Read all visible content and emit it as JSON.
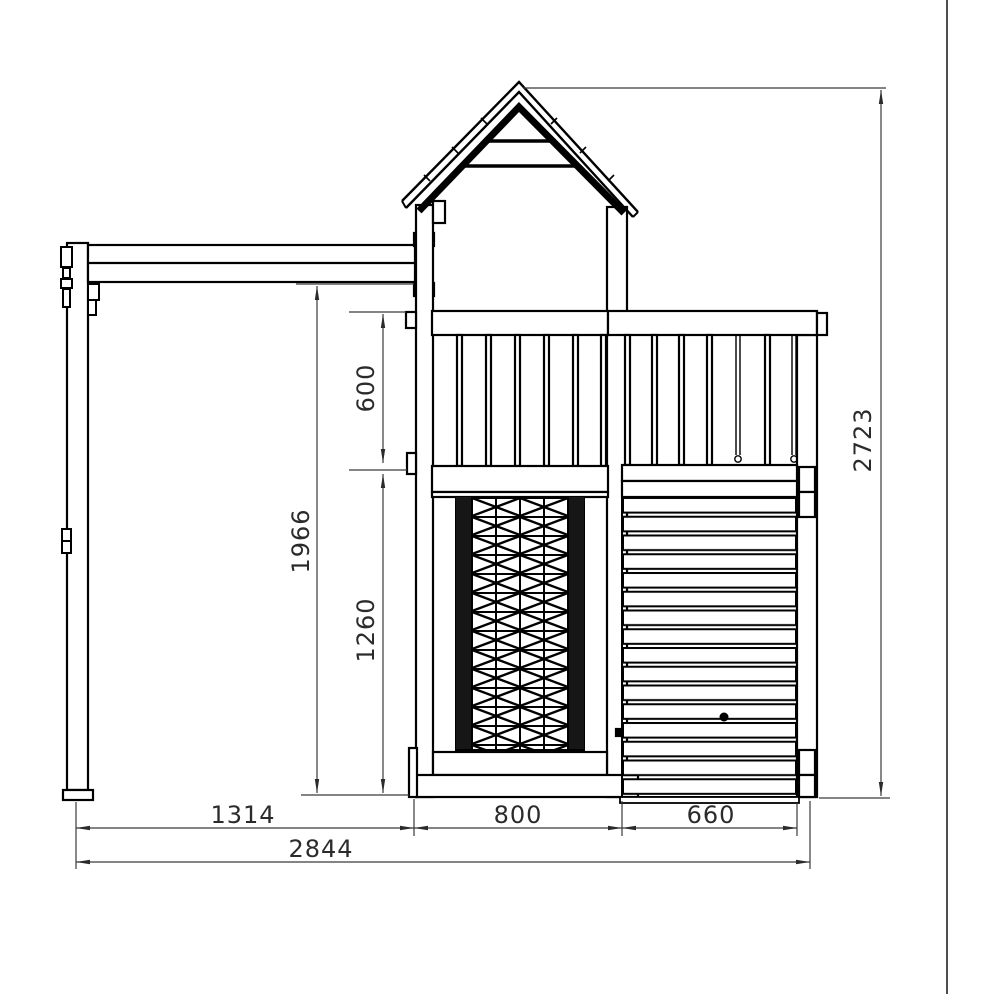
{
  "drawing": {
    "background_color": "#ffffff",
    "line_color": "#000000",
    "dimension_color": "#2b2b2b"
  },
  "dimensions": {
    "overall_height": "2723",
    "beam_underside_height": "1966",
    "railing_height": "600",
    "deck_to_ground": "1260",
    "swing_bay_width": "1314",
    "tower_width": "800",
    "climb_wall_width": "660",
    "overall_width": "2844"
  }
}
